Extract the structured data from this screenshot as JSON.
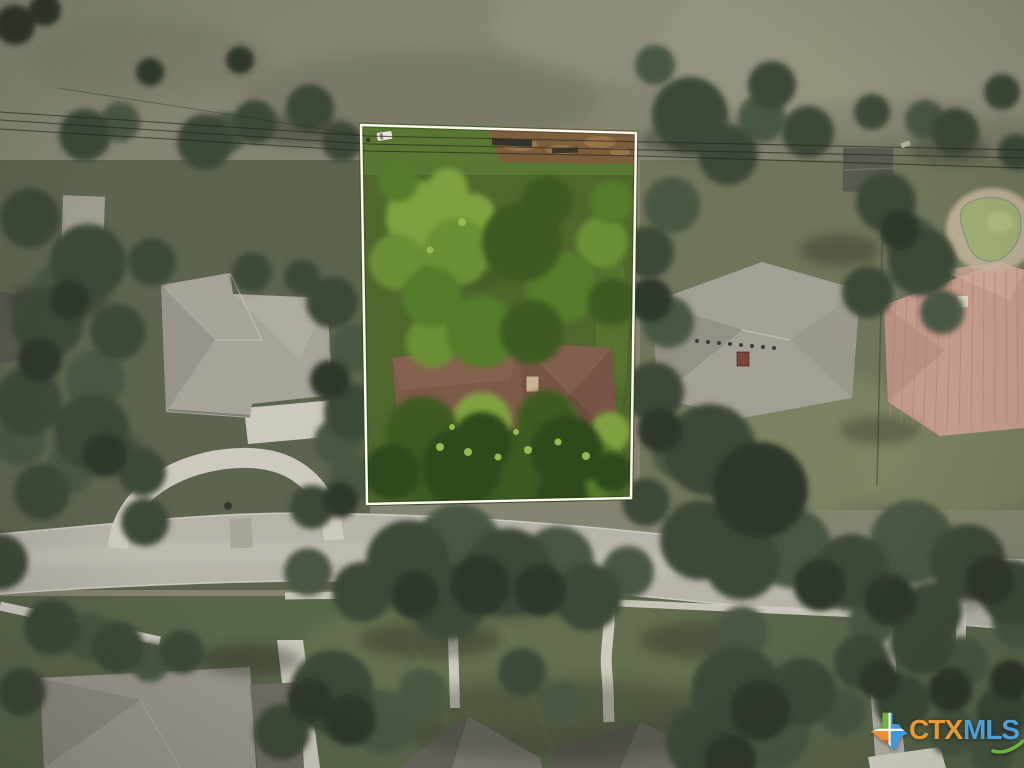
{
  "image": {
    "kind": "aerial-drone-photo",
    "subject": "Overhead view of a wooded residential lot outlined with a white property boundary, neighboring homes, a street, pool and lawns"
  },
  "boundary": {
    "color": "#FAF8EC",
    "shape": "quadrilateral"
  },
  "watermark": {
    "brand_ctx": "CTX",
    "brand_mls": "MLS",
    "icon": "texas-state-icon",
    "colors": {
      "ctx_text": "#E8992F",
      "mls_text": "#4E9FD6",
      "texas_green": "#6CB33E",
      "texas_blue": "#3F9BD8",
      "texas_orange": "#EE8F2E",
      "texas_red": "#E0562B",
      "swoosh_green": "#6CB33E"
    }
  },
  "palette": {
    "field": "#848471",
    "field_light": "#93937F",
    "lawn_muted": "#5D644E",
    "lawn_bright": "#7D8462",
    "lawn_bottom": "#59654A",
    "road": "#B6B3A9",
    "concrete": "#CDC9BE",
    "tree_dark": "#3E4937",
    "tree_mid": "#4A5642",
    "tree_deep": "#2F3829",
    "lot_grass": "#4F662C",
    "lot_tree_bright": "#7FA040",
    "dirt": "#7C5E3C",
    "subject_roof": "#7D5A49",
    "neighbor_roof_gray": "#A29F94",
    "neighbor_roof_metal": "#C49A8C",
    "pool_water": "#9FAE74"
  }
}
